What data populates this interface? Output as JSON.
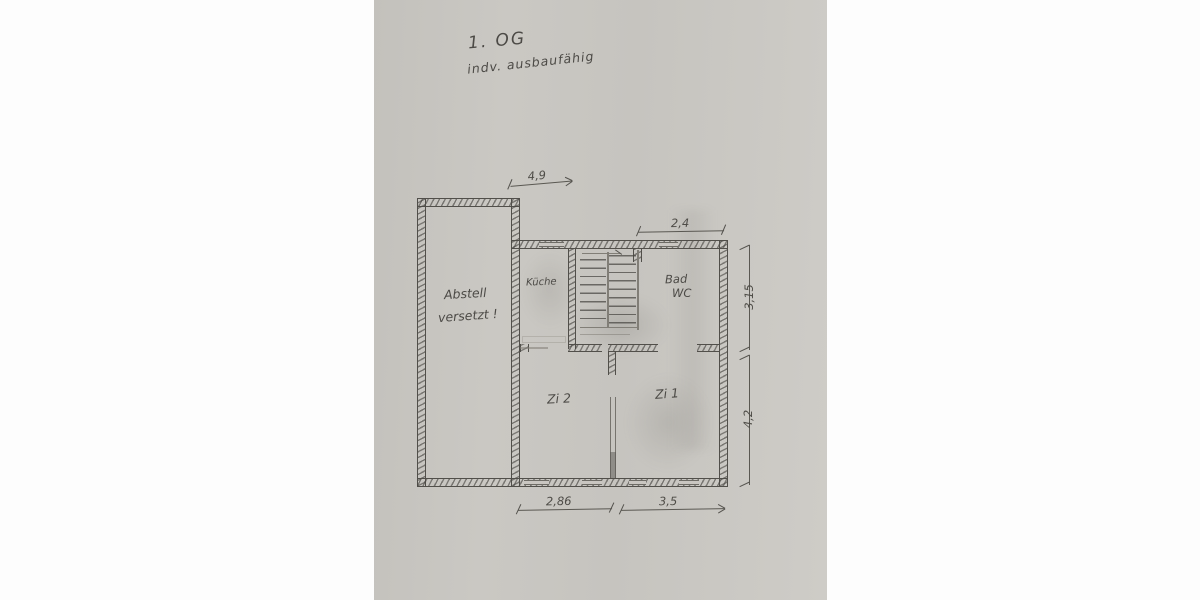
{
  "photo": {
    "paper_color": "#c9c6c0",
    "pencil_color": "#55534e"
  },
  "header": {
    "title": "1. OG",
    "subtitle": "indv. ausbaufähig"
  },
  "rooms": {
    "abstell": {
      "label": "Abstell",
      "note": "versetzt !"
    },
    "kueche": {
      "label": "Küche"
    },
    "bad": {
      "line1": "Bad",
      "line2": "WC"
    },
    "zi2": {
      "label": "Zi 2"
    },
    "zi1": {
      "label": "Zi 1"
    }
  },
  "dimensions": {
    "top": "4,9",
    "top_right": "2,4",
    "right_upper": "3,15",
    "right_lower": "4,2",
    "bottom_left": "2,86",
    "bottom_right": "3,5"
  }
}
